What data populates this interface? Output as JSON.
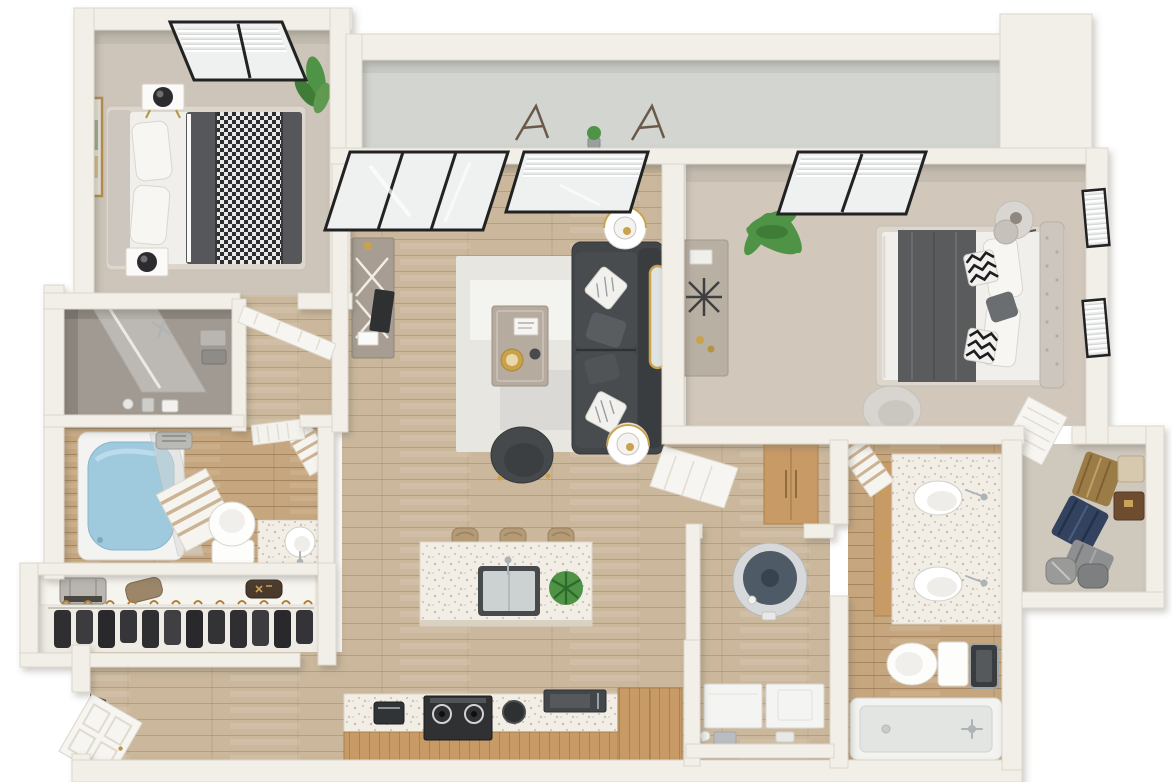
{
  "scene": {
    "type": "3d-floor-plan-render",
    "unit": "two-bedroom-two-bath-apartment",
    "view": "top-down-dollhouse",
    "background": "#ffffff"
  },
  "colors": {
    "wall": "#f2efe9",
    "wall_face": "#e4dfd6",
    "carpet_bed1": "#cdc5b9",
    "carpet_bed2": "#d1c7bb",
    "carpet_closet": "#cfc8bd",
    "gray_room_floor": "#a19a92",
    "wood_floor": "#cbb89c",
    "bath_tile": "#c5a67e",
    "balcony_floor": "#d3d5d1",
    "closet_floor": "#efece6",
    "rug": "#e7e6e1",
    "sofa": "#434648",
    "sofa_back": "#3a3d3f",
    "pillow_dark": "#5a5d5f",
    "accent_chair": "#46494b",
    "chair_light": "#d8d5d0",
    "coffee_table": "#b5ab9e",
    "side_table": "#ffffff",
    "gold": "#c9a24a",
    "terrazzo": "#f2eee6",
    "cabinet_wood": "#c79a66",
    "appliance_black": "#2f3133",
    "microwave_dark": "#43474a",
    "water_heater_top": "#4e5a66",
    "water_heater_body": "#d6d8d9",
    "tub_water": "#9fcade",
    "tub_white": "#f3f3f1",
    "toilet_white": "#fdfdfc",
    "washer_white": "#f4f4f2",
    "plant_green": "#4f9347",
    "plant_green_dark": "#3e7c38",
    "clothes_dark": "#2f2f31",
    "clothes_tan": "#9c7c46",
    "clothes_navy": "#33435f",
    "clothes_gray": "#8d8f91",
    "hanger_gold": "#b07f35",
    "window_frame": "#222222",
    "glass": "#eef1f0",
    "door_white": "#f7f5f1",
    "headboard": "#ccc6be",
    "duvet_dark": "#55575a",
    "runner_dark": "#595b5d",
    "mattress_white": "#f1efeb",
    "dresser_taupe": "#b9b0a4",
    "console_gray": "#a79d92",
    "stool_tan": "#b59a76",
    "towel_stripe": "#cbb394",
    "suitcase_silver": "#b9b6b1",
    "box_beige": "#d6c9ae",
    "box_brown": "#6d4c2f"
  },
  "rooms": [
    {
      "id": "bedroom-1",
      "furniture": [
        "queen-bed-dark-duvet-houndstooth-throw",
        "headboard",
        "nightstand-2x",
        "sphere-lamp-2x",
        "wall-art-gold-frame",
        "potted-plant",
        "window-with-blinds"
      ]
    },
    {
      "id": "shower-room",
      "furniture": [
        "glass-shower-panel",
        "shower-fixture",
        "towel-stack",
        "toiletries"
      ]
    },
    {
      "id": "bathroom-1",
      "furniture": [
        "bathtub-with-water",
        "glass-panel",
        "striped-towel-2x",
        "toilet",
        "terrazzo-vanity-round-sink",
        "exhaust-fan"
      ]
    },
    {
      "id": "entry-closet",
      "furniture": [
        "shelf",
        "suitcase",
        "bag-2x",
        "hanging-clothes-rod"
      ]
    },
    {
      "id": "entry",
      "furniture": [
        "front-door-open"
      ]
    },
    {
      "id": "living-room",
      "furniture": [
        "sliding-glass-door-3-panel",
        "window-with-blinds",
        "media-console-x-doors",
        "tv",
        "area-rug",
        "coffee-table",
        "sectional-sofa-charcoal",
        "throw-pillows",
        "side-table-lamp-2x",
        "accent-chair",
        "arched-gold-mirror"
      ]
    },
    {
      "id": "balcony",
      "furniture": [
        "parapet-wall",
        "corner-column",
        "folding-chair-2x",
        "small-potted-plant"
      ]
    },
    {
      "id": "kitchen",
      "furniture": [
        "terrazzo-island-with-sink",
        "faucet",
        "potted-plant",
        "bar-stool-3x",
        "range-black",
        "espresso-machine",
        "trash-bin",
        "microwave",
        "base-cabinets-oak",
        "tall-cabinet-oak"
      ]
    },
    {
      "id": "hallway",
      "furniture": [
        "linen-cabinet-oak",
        "open-door"
      ]
    },
    {
      "id": "utility-closet",
      "furniture": [
        "water-heater",
        "washer",
        "dryer",
        "storage-boxes"
      ]
    },
    {
      "id": "bedroom-2",
      "furniture": [
        "queen-bed-white-gray-runner",
        "tufted-headboard",
        "chevron-pillows",
        "sculpted-lamp",
        "dresser-with-starburst-decor",
        "palm-plant",
        "window-with-blinds-3x",
        "lounge-chair"
      ]
    },
    {
      "id": "bathroom-2",
      "furniture": [
        "double-sink-terrazzo-vanity",
        "faucet-2x",
        "striped-towel",
        "toilet",
        "trash-bin",
        "tub-shower",
        "tub-faucet"
      ]
    },
    {
      "id": "walk-in-closet",
      "furniture": [
        "open-louver-door",
        "hanging-clothes-tan",
        "hanging-clothes-navy",
        "hanging-clothes-gray",
        "storage-box-2x",
        "duffel-bag-2x"
      ]
    }
  ]
}
